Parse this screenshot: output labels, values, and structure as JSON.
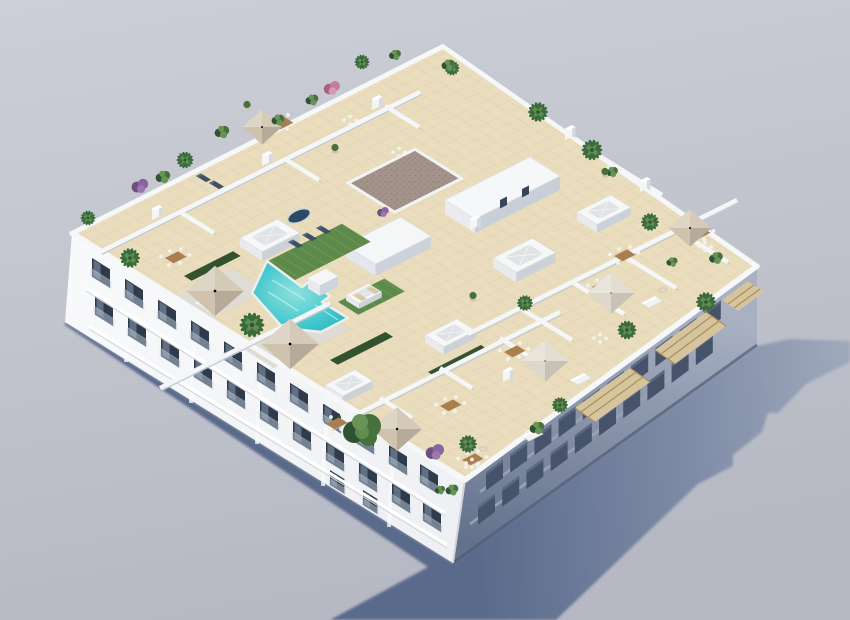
{
  "meta": {
    "title": "Aerial 3D architectural rendering",
    "description": "Aerial isometric 3D rendering of a white residential apartment building with a communal rooftop terrace: L-shaped turquoise swimming pool, artificial grass lawns with sun loungers, cream tiled decks, private terraces with parasols and dining sets, white skylight boxes, potted palms and shrubs, pergola slats over the shaded south-east facade, and a long blue-grey shadow cast on the pavement.",
    "type": "architectural-visualization",
    "view": "aerial-isometric"
  },
  "colors": {
    "bg_top": "#cdcfd8",
    "bg_bottom": "#b6b9c3",
    "shadow_near": "#5a6b8b",
    "shadow_mid": "#7d8aa5",
    "shadow_far": "#9ea8bb",
    "facade_white": "#eef0f3",
    "facade_bright": "#f8f9fb",
    "facade_shade_top": "#a8b0c2",
    "facade_shade_bottom": "#64718c",
    "window_dark": "#2f3a4c",
    "window_shadow_side": "#46536b",
    "glass": "#b9c7d6",
    "roof_tile": "#e9ddbd",
    "tile_line": "#cbb98f",
    "lawn": "#5d8a4a",
    "lawn_light": "#6f9c58",
    "hedge": "#33522f",
    "pool": "#3ec6cc",
    "pool_deep": "#2ba8b4",
    "pool_light": "#8fe0de",
    "wall_white": "#f5f6f7",
    "wall_shade": "#c5cad2",
    "gravel": "#a3938a",
    "gravel_dark": "#8d7d74",
    "umbrella_cream": "#ded8ca",
    "umbrella_tan": "#cfc3ad",
    "deck_grey": "#dedcd4",
    "plant_dark": "#2f5232",
    "plant_mid": "#47703c",
    "plant_light": "#679455",
    "palm": "#3a6b3c",
    "purple_bush": "#8a64a0",
    "pink_bush": "#c27d9b",
    "wood": "#a97f4f",
    "furniture_white": "#f2f2ef",
    "pergola": "#d6c49c",
    "pergola_line": "#a8905f",
    "spa": "#2c4a66"
  },
  "scene": {
    "building": {
      "storeys_visible": 3,
      "facades_visible": 2,
      "lit_facade": "south-west",
      "shaded_facade": "south-east",
      "front_window_rows": 2
    },
    "rooftop": {
      "pool_count": 1,
      "pool_shape": "L-shaped",
      "skylight_count": 6,
      "parasol_count": 7,
      "sun_lounger_count": 9,
      "dining_table_count": 9,
      "planter_count": 30,
      "lawn_surface": "artificial grass",
      "deck_surface": "cream ceramic tiles",
      "gravel_roof_patches": 1,
      "pergola_sections": 3
    }
  }
}
